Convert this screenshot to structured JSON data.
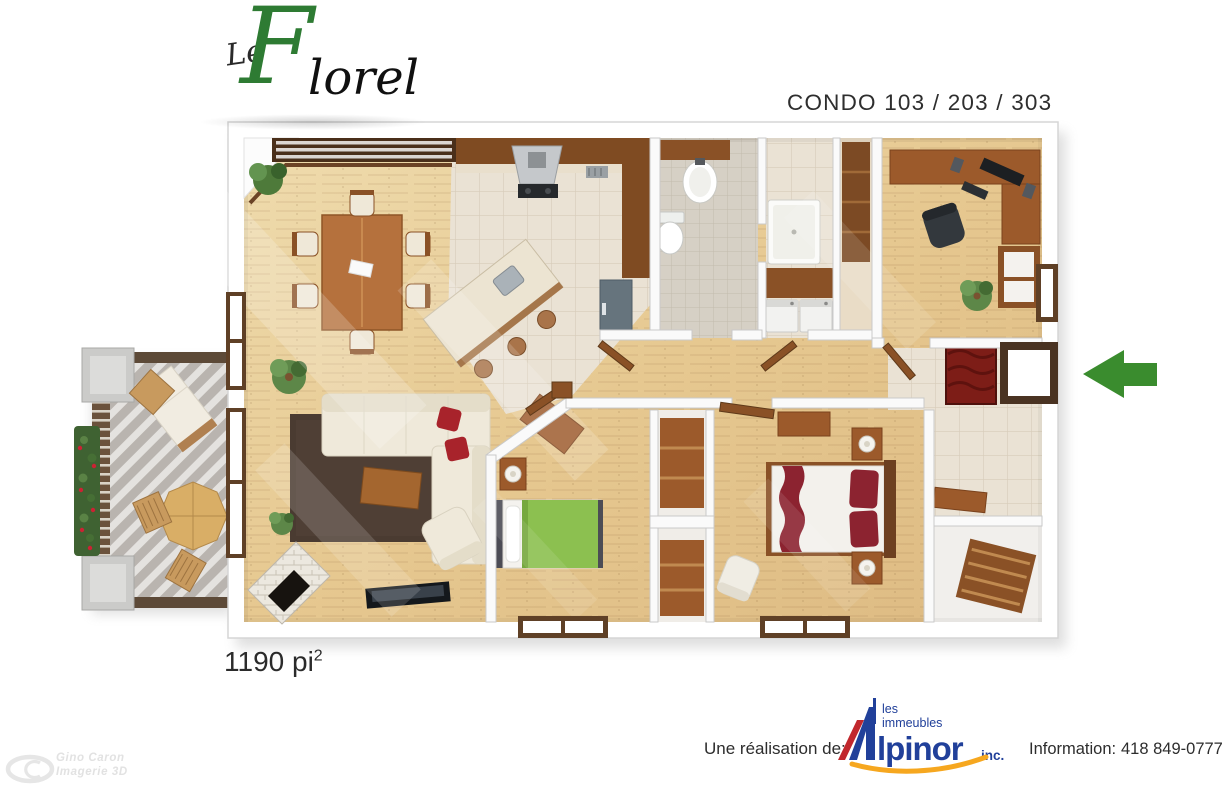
{
  "page": {
    "background": "#ffffff"
  },
  "logo": {
    "le": "Le",
    "initial": "F",
    "rest": "lorel",
    "green": "#2e7b33",
    "dark": "#101010"
  },
  "header": {
    "condo_title": "CONDO 103 / 203 / 303"
  },
  "area_label": {
    "text": "1190 pi",
    "superscript": "2"
  },
  "footer": {
    "realization_label": "Une réalisation de:",
    "brand": {
      "line1": "les",
      "line2": "immeubles",
      "name_rest": "lpinor",
      "suffix": "inc.",
      "blue": "#21409a",
      "red": "#c1272d",
      "orange": "#f6a71f"
    },
    "information_label": "Information:",
    "phone": "418 849-0777"
  },
  "watermark": {
    "line1": "Gino Caron",
    "line2": "Imagerie 3D"
  },
  "floorplan": {
    "entrance_arrow": {
      "direction": "left",
      "color": "#3a8c2e"
    },
    "palette": {
      "wood_floor": "#e7cb9a",
      "kitchen_tile": "#eae2d4",
      "bath_tile": "#d6d0c5",
      "wall": "#fafafa",
      "wood_furniture": "#9c5a2b",
      "sofa": "#efe9da",
      "rug": "#4a3b31",
      "bed_green": "#8cc050",
      "bed_burgundy": "#8c2330",
      "balcony_deck": "#b9b4af",
      "stainless": "#c5c8cb"
    },
    "rooms": [
      "balcony",
      "dining-room",
      "kitchen",
      "bathroom",
      "shower-room",
      "storage-closet",
      "laundry",
      "office",
      "hallway",
      "entrance",
      "living-room",
      "bedroom",
      "master-bedroom",
      "entry-storage"
    ]
  }
}
